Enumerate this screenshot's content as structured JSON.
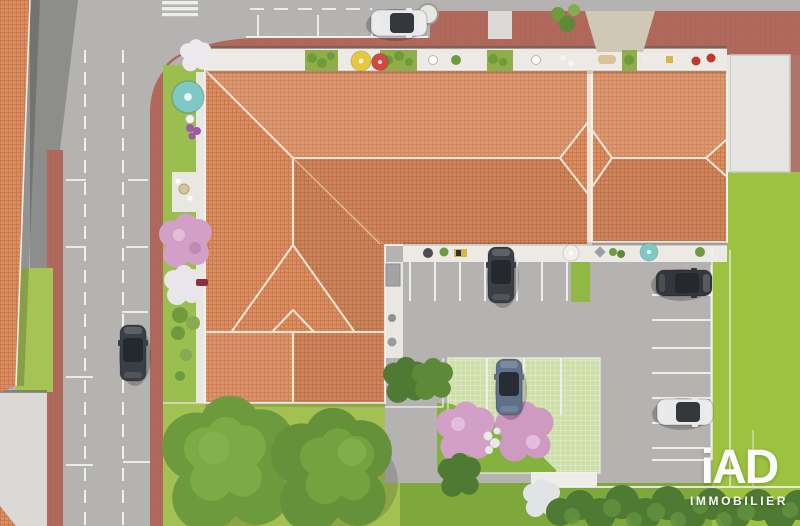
{
  "page": {
    "type": "aerial-3d-render",
    "subject": "Bird's-eye 3D visualization of a residential building with gardens, terraces, streets and parking"
  },
  "logo": {
    "brand": "iAD",
    "subtitle": "IMMOBILIER",
    "color": "#ffffff"
  },
  "colors": {
    "road": "#b5b3b1",
    "road_dark": "#8d8d8b",
    "sidewalk_brick": "#b0695b",
    "driveway_pale": "#dbd9d5",
    "driveway_beige": "#cfc8b6",
    "concrete_patio": "#e6e4e0",
    "terrace_white": "#edeae5",
    "walkway_white": "#e9e7e2",
    "roof_tile": "#dd8d62",
    "roof_ridge": "#f2ecdd",
    "lawn": "#a3c153",
    "lawn_bright": "#9cc23f",
    "lawn_center": "#85b13e",
    "garden_grass": "#9abf4e",
    "grass_paver": "#cedfa9",
    "tree": "#6d9a3d",
    "tree_light": "#86b24c",
    "hedge": "#4e7a33",
    "pink_bloom": "#d2a0c6",
    "white_bloom": "#e9e7ea",
    "marking_white": "#f2f2ef",
    "car_dark_gray": "#3a3e45",
    "car_black": "#33363c",
    "car_white": "#e9e9eb",
    "car_blue_gray": "#5f7089",
    "parasol_teal": "#7fc9c4",
    "parasol_yellow": "#e5c83e",
    "parasol_red": "#cf4a41",
    "parasol_white": "#f0efec"
  },
  "scene": {
    "buildings": [
      {
        "name": "main-residence",
        "description": "L-shaped terracotta hip roof, center of plot"
      },
      {
        "name": "right-wing",
        "description": "terracotta hip roof block, right of main roof"
      },
      {
        "name": "neighbor-building",
        "description": "terracotta roof edge, left border of image"
      }
    ],
    "streets": [
      {
        "name": "vertical-street",
        "markings": "two dashed lane lines, parallel parking bays, crosswalk at corner",
        "moving_cars": 1
      },
      {
        "name": "horizontal-street",
        "markings": "dashed center line, marked parking lane",
        "parked_cars": 1
      }
    ],
    "parking_areas": [
      {
        "name": "courtyard-stalls",
        "surface": "asphalt, white lines",
        "cars": 1,
        "green_stall": true
      },
      {
        "name": "right-stall-row",
        "surface": "asphalt, white lines",
        "cars": 2
      },
      {
        "name": "grass-paver-stalls",
        "surface": "grass pavers",
        "cars": 1
      }
    ],
    "cars": [
      {
        "location": "top street parking lane",
        "color": "white"
      },
      {
        "location": "left street, driving lane",
        "color": "dark gray"
      },
      {
        "location": "courtyard stall",
        "color": "dark gray"
      },
      {
        "location": "grass-paver stall",
        "color": "blue gray"
      },
      {
        "location": "right row, upper stall",
        "color": "black"
      },
      {
        "location": "right row, lower stall",
        "color": "white"
      }
    ],
    "parasols": [
      {
        "location": "front garden",
        "color": "teal"
      },
      {
        "location": "top terrace strip",
        "color": "yellow"
      },
      {
        "location": "top terrace strip",
        "color": "red"
      },
      {
        "location": "center terrace strip",
        "color": "white"
      },
      {
        "location": "center terrace strip",
        "color": "teal"
      }
    ],
    "vegetation": {
      "large_trees": 2,
      "pink_flowering_trees": 3,
      "white_flowering_trees": 3,
      "hedge_row": "dark shrubs along bottom edge",
      "lawns": "front garden strip, bottom lawns, right lawn",
      "terrace_planters": "small shrubs and plants along both terrace strips"
    }
  }
}
